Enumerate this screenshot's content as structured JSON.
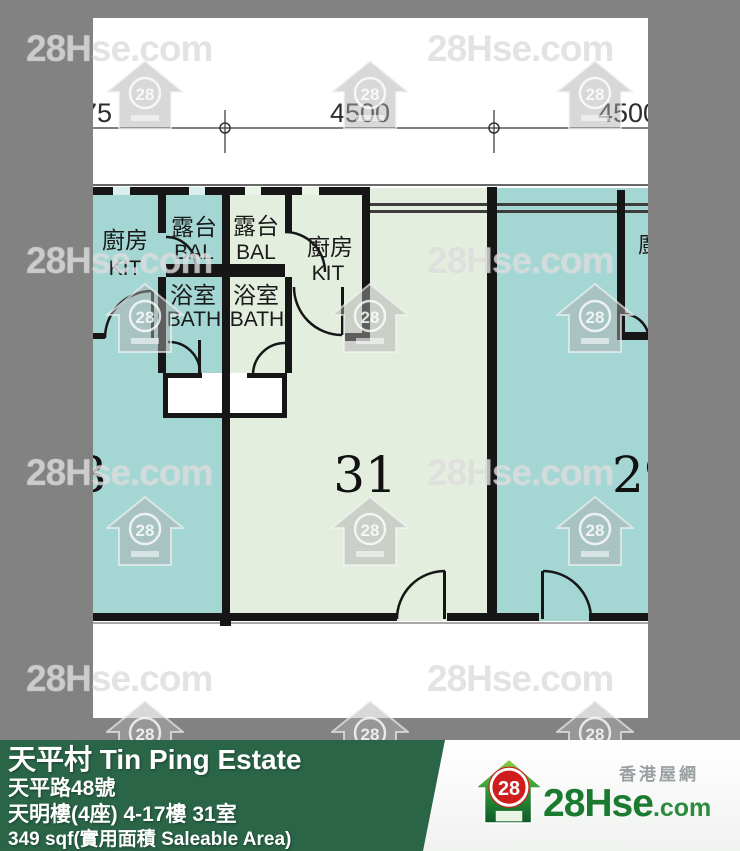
{
  "plan": {
    "dimensions": {
      "d1": "75",
      "d2": "4500",
      "d3": "4500"
    },
    "units": {
      "left": {
        "number": "3",
        "rooms": {
          "kitchen_zh": "廚房",
          "kitchen_en": "KIT",
          "balcony_zh": "露台",
          "balcony_en": "BAL",
          "bath_zh": "浴室",
          "bath_en": "BATH"
        }
      },
      "middle": {
        "number": "31",
        "rooms": {
          "kitchen_zh": "廚房",
          "kitchen_en": "KIT",
          "balcony_zh": "露台",
          "balcony_en": "BAL",
          "bath_zh": "浴室",
          "bath_en": "BATH"
        }
      },
      "right": {
        "number": "29",
        "rooms": {
          "kitchen_zh": "廚房"
        }
      }
    },
    "colors": {
      "teal_room": "#a4d6d3",
      "green_room": "#e4eedf",
      "wall": "#161616",
      "plan_bg": "#ffffff"
    }
  },
  "info_bar": {
    "estate_name": "天平村 Tin Ping Estate",
    "address": "天平路48號",
    "block_floor_unit": "天明樓(4座) 4-17樓 31室",
    "area": "349 sqf(實用面積 Saleable Area)",
    "bg_color": "#2a6548"
  },
  "branding": {
    "site_name_zh": "香港屋網",
    "logo_text_main": "28Hse",
    "logo_text_suffix": ".com",
    "logo_badge": "28",
    "logo_green": "#1a7a30",
    "logo_red": "#cf1d1d"
  },
  "watermarks": {
    "text": "28Hse.com",
    "badge": "28",
    "text_positions": [
      {
        "x": 26,
        "y": 28
      },
      {
        "x": 427,
        "y": 28
      },
      {
        "x": 26,
        "y": 240
      },
      {
        "x": 427,
        "y": 240
      },
      {
        "x": 26,
        "y": 452
      },
      {
        "x": 427,
        "y": 452
      },
      {
        "x": 26,
        "y": 658
      },
      {
        "x": 427,
        "y": 658
      }
    ],
    "house_positions": [
      {
        "x": 106,
        "y": 60
      },
      {
        "x": 331,
        "y": 60
      },
      {
        "x": 556,
        "y": 60
      },
      {
        "x": 106,
        "y": 283
      },
      {
        "x": 331,
        "y": 283
      },
      {
        "x": 556,
        "y": 283
      },
      {
        "x": 106,
        "y": 496
      },
      {
        "x": 331,
        "y": 496
      },
      {
        "x": 556,
        "y": 496
      },
      {
        "x": 106,
        "y": 700
      },
      {
        "x": 331,
        "y": 700
      },
      {
        "x": 556,
        "y": 700
      }
    ],
    "background_color": "#828282"
  }
}
